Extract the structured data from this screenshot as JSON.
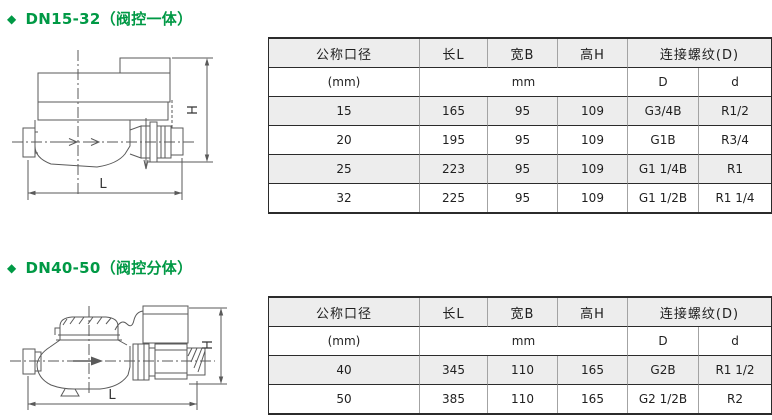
{
  "colors": {
    "accent_green": "#009945",
    "row_shade": "#ededed",
    "grid_dark": "#2b2b2b",
    "grid_light": "#a3a3a3"
  },
  "section1": {
    "bullet": "◆",
    "title": "DN15-32（阀控一体）",
    "diagram": {
      "h_label": "H",
      "l_label": "L"
    },
    "table": {
      "headers": {
        "bore": "公称口径",
        "length": "长L",
        "width": "宽B",
        "height": "高H",
        "thread": "连接螺纹(D)"
      },
      "subheaders": {
        "bore_unit": "(mm)",
        "unit": "mm",
        "thread_D": "D",
        "thread_d": "d"
      },
      "rows": [
        {
          "dn": "15",
          "l": "165",
          "b": "95",
          "h": "109",
          "D": "G3/4B",
          "d": "R1/2"
        },
        {
          "dn": "20",
          "l": "195",
          "b": "95",
          "h": "109",
          "D": "G1B",
          "d": "R3/4"
        },
        {
          "dn": "25",
          "l": "223",
          "b": "95",
          "h": "109",
          "D": "G1 1/4B",
          "d": "R1"
        },
        {
          "dn": "32",
          "l": "225",
          "b": "95",
          "h": "109",
          "D": "G1 1/2B",
          "d": "R1 1/4"
        }
      ]
    }
  },
  "section2": {
    "bullet": "◆",
    "title": "DN40-50（阀控分体）",
    "diagram": {
      "h_label": "H",
      "l_label": "L"
    },
    "table": {
      "headers": {
        "bore": "公称口径",
        "length": "长L",
        "width": "宽B",
        "height": "高H",
        "thread": "连接螺纹(D)"
      },
      "subheaders": {
        "bore_unit": "(mm)",
        "unit": "mm",
        "thread_D": "D",
        "thread_d": "d"
      },
      "rows": [
        {
          "dn": "40",
          "l": "345",
          "b": "110",
          "h": "165",
          "D": "G2B",
          "d": "R1 1/2"
        },
        {
          "dn": "50",
          "l": "385",
          "b": "110",
          "h": "165",
          "D": "G2 1/2B",
          "d": "R2"
        }
      ]
    }
  }
}
